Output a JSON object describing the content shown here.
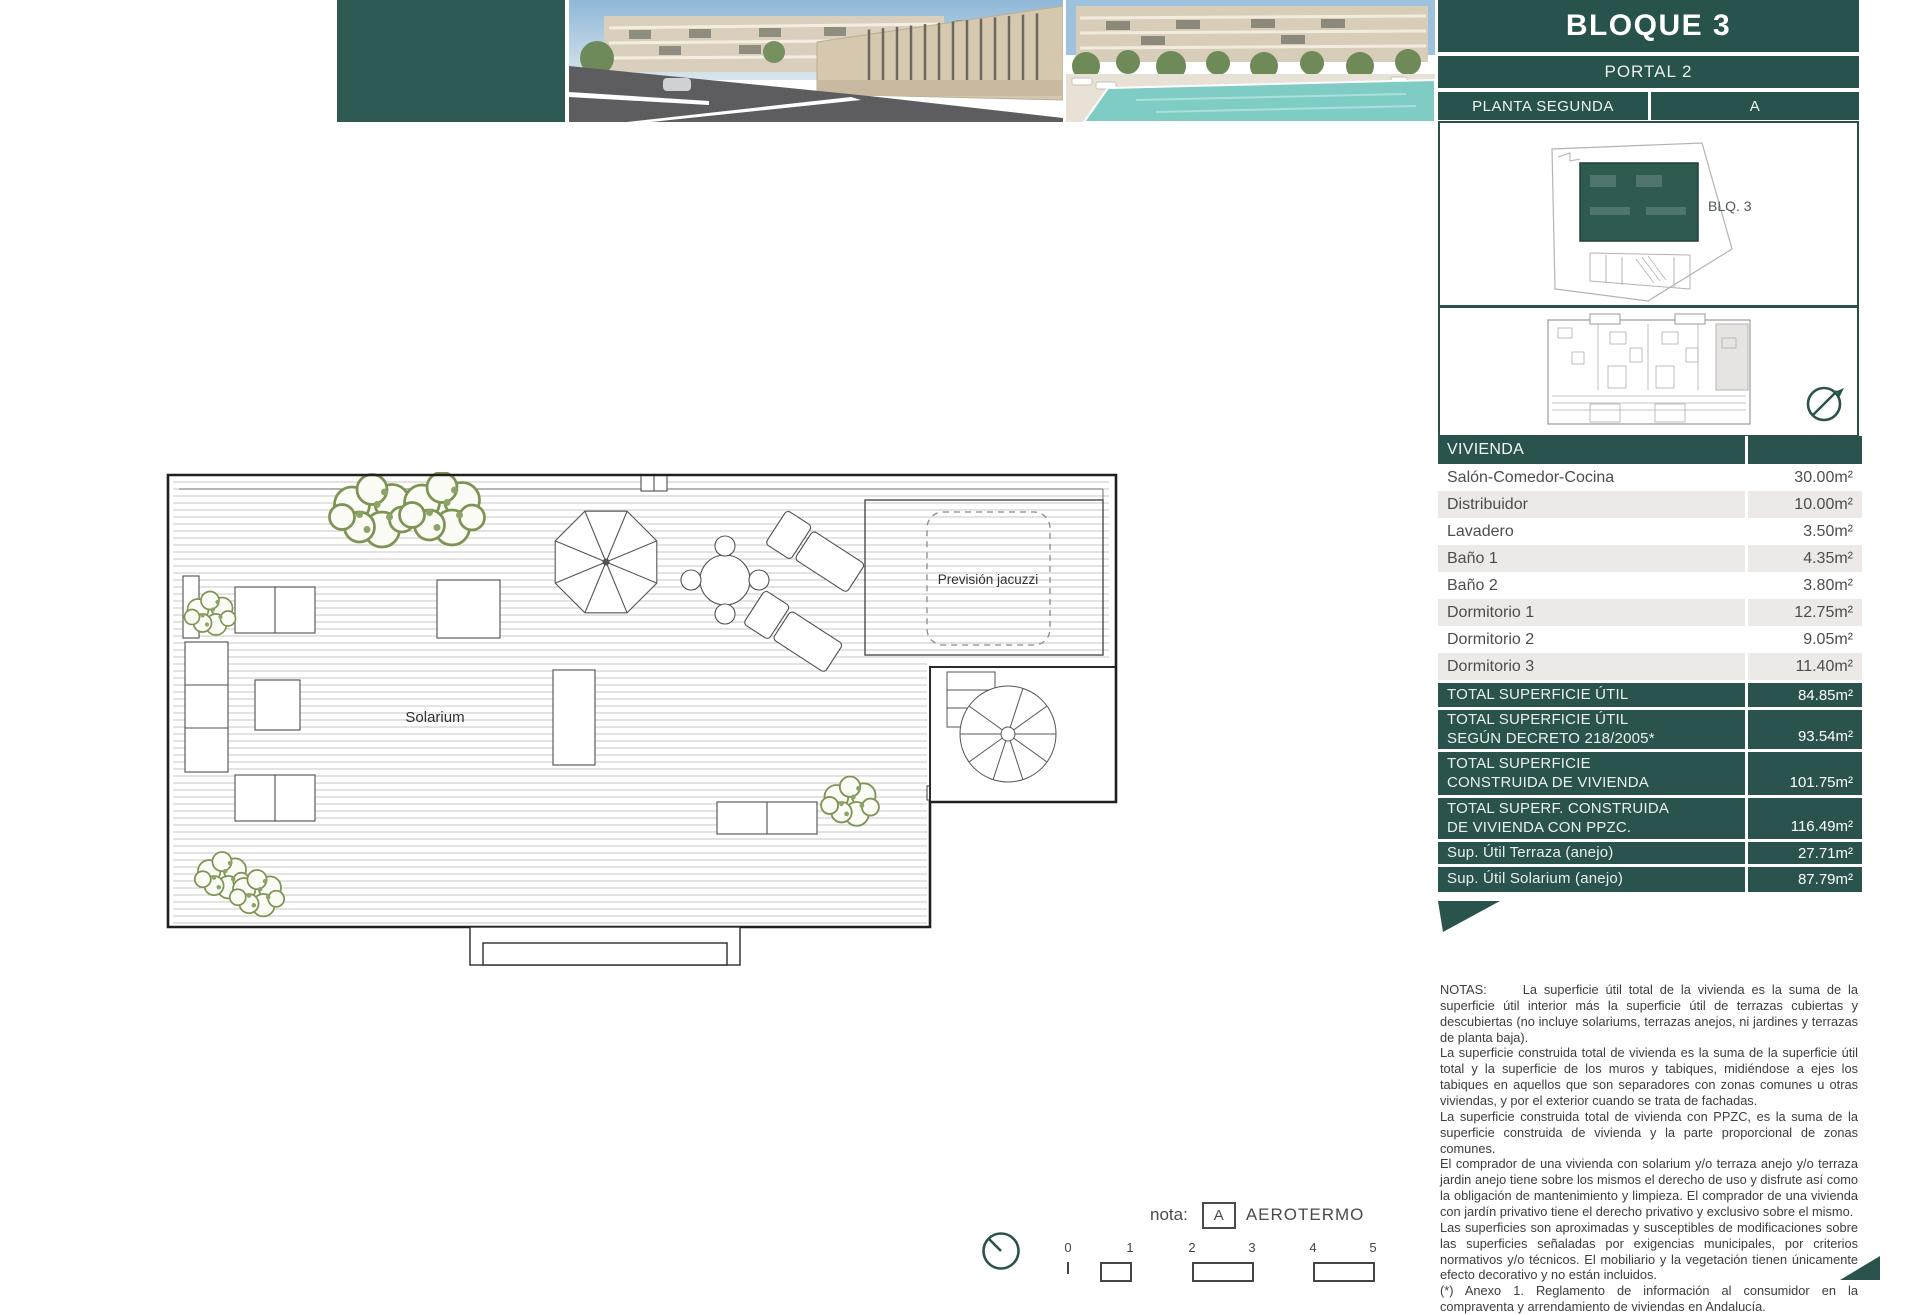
{
  "header": {
    "block_title": "BLOQUE 3",
    "portal": "PORTAL 2",
    "floor": "PLANTA SEGUNDA",
    "unit": "A"
  },
  "site_plan": {
    "blq_label": "BLQ. 3"
  },
  "floor_plan": {
    "solarium_label": "Solarium",
    "jacuzzi_label": "Previsión jacuzzi"
  },
  "table": {
    "header": "VIVIENDA",
    "rows": [
      {
        "label": "Salón-Comedor-Cocina",
        "value": "30.00m²"
      },
      {
        "label": "Distribuidor",
        "value": "10.00m²"
      },
      {
        "label": "Lavadero",
        "value": "3.50m²"
      },
      {
        "label": "Baño 1",
        "value": "4.35m²"
      },
      {
        "label": "Baño 2",
        "value": "3.80m²"
      },
      {
        "label": "Dormitorio 1",
        "value": "12.75m²"
      },
      {
        "label": "Dormitorio 2",
        "value": "9.05m²"
      },
      {
        "label": "Dormitorio 3",
        "value": "11.40m²"
      }
    ],
    "totals": [
      {
        "label": "TOTAL SUPERFICIE ÚTIL",
        "value": "84.85m²"
      },
      {
        "label": "TOTAL SUPERFICIE ÚTIL SEGÚN DECRETO 218/2005*",
        "value": "93.54m²"
      },
      {
        "label": "TOTAL SUPERFICIE CONSTRUIDA DE VIVIENDA",
        "value": "101.75m²"
      },
      {
        "label": "TOTAL SUPERF. CONSTRUIDA DE VIVIENDA CON PPZC.",
        "value": "116.49m²"
      },
      {
        "label": "Sup. Útil Terraza (anejo)",
        "value": "27.71m²"
      },
      {
        "label": "Sup. Útil Solarium (anejo)",
        "value": "87.79m²"
      }
    ]
  },
  "notes": {
    "label": "NOTAS:",
    "paragraphs": [
      "La superficie útil total de la vivienda es la suma de la superficie útil interior más la superficie útil de terrazas cubiertas y descubiertas (no incluye solariums, terrazas anejos, ni jardines y terrazas de planta baja).",
      "La superficie construida total de vivienda es la suma de la superficie útil total y la superficie de los muros y tabiques, midiéndose a ejes los tabiques en aquellos que son separadores con zonas comunes u otras viviendas, y por el exterior cuando se trata de fachadas.",
      "La superficie construida total de vivienda con PPZC, es la suma de la superficie construida de vivienda y la parte proporcional de zonas comunes.",
      "El comprador de una vivienda con solarium y/o terraza anejo y/o terraza jardin anejo tiene sobre los mismos el derecho de uso y disfrute así como la obligación de mantenimiento y limpieza. El comprador de una vivienda con jardín privativo tiene el derecho privativo y exclusivo sobre el mismo.",
      "Las superficies son aproximadas y susceptibles de modificaciones sobre las superficies señaladas por exigencias municipales, por criterios normativos y/o técnicos. El mobiliario y la vegetación tienen únicamente efecto decorativo y no están incluidos.",
      "(*) Anexo 1. Reglamento de información al consumidor en la compraventa y arrendamiento de viviendas en Andalucía."
    ]
  },
  "footer": {
    "nota_label": "nota:",
    "aerotermo_key": "A",
    "aerotermo_label": "AEROTERMO",
    "scale_labels": [
      "0",
      "1",
      "2",
      "3",
      "4",
      "5"
    ]
  },
  "colors": {
    "teal": "#2a534d",
    "row_alt": "#ece9e6",
    "pool": "#7fccc4"
  }
}
